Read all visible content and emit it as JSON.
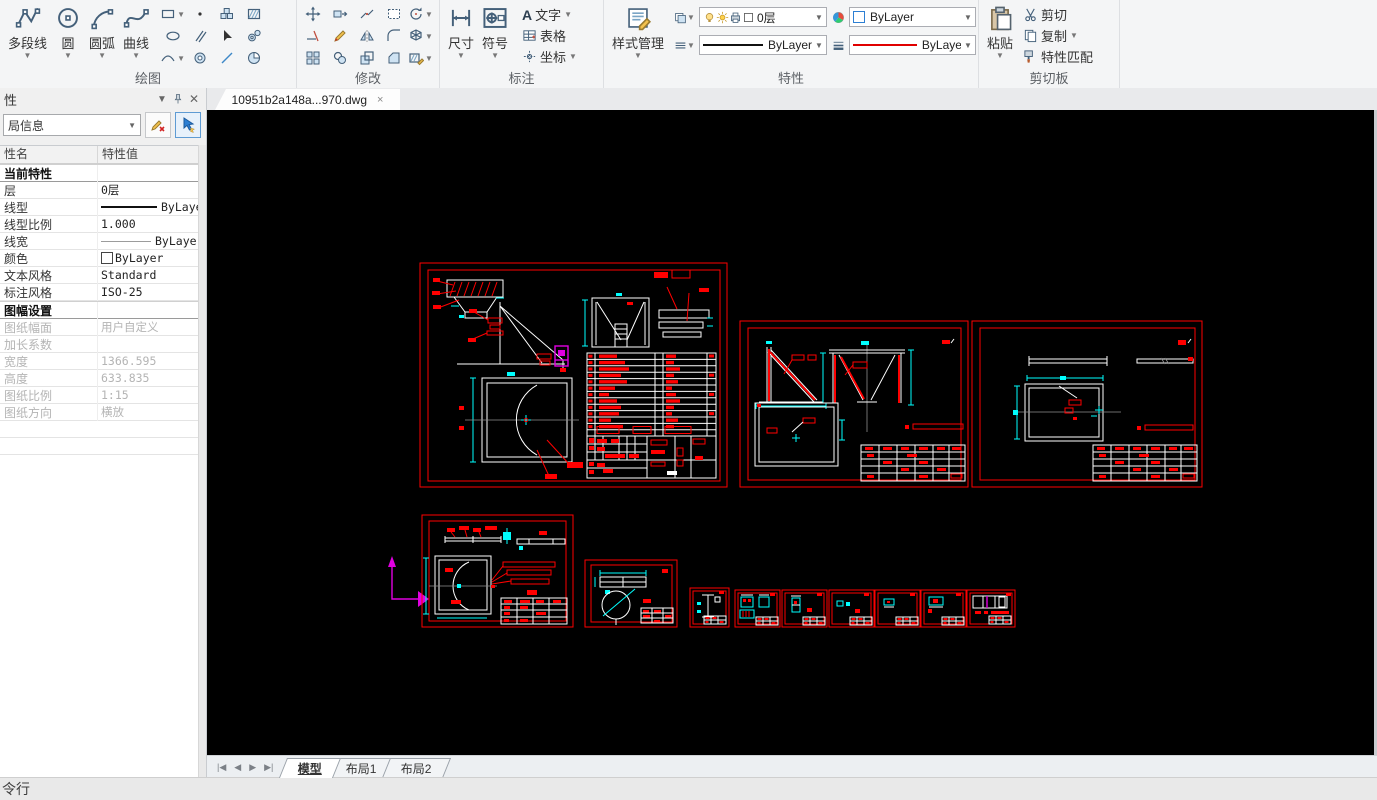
{
  "ribbon": {
    "draw": {
      "label": "绘图",
      "polyline": "多段线",
      "circle": "圆",
      "arc": "圆弧",
      "spline": "曲线",
      "small_icons": [
        "rectangle",
        "ellipse",
        "curve",
        "point",
        "parallel",
        "donut",
        "blocks",
        "pick-arrow",
        "line",
        "hatch",
        "gears",
        "pie"
      ]
    },
    "modify": {
      "label": "修改",
      "small_icons": [
        "move",
        "trim",
        "array",
        "stretch",
        "edit-pencil",
        "copy-object",
        "break",
        "mirror",
        "scale",
        "select-rect",
        "fillet",
        "chamfer",
        "rotate",
        "explode",
        "hatch-edit"
      ]
    },
    "annotate": {
      "label": "标注",
      "dim": "尺寸",
      "symbol": "符号",
      "text": "文字",
      "table": "表格",
      "coord": "坐标"
    },
    "props": {
      "label": "特性",
      "style_manager": "样式管理",
      "layer": "0层",
      "color": "ByLayer",
      "linetype": "ByLayer",
      "lineweight": "ByLayer",
      "layer_icons": [
        "bulb",
        "sun",
        "printer",
        "layer-color"
      ]
    },
    "clipboard": {
      "label": "剪切板",
      "paste": "粘贴",
      "cut": "剪切",
      "copy": "复制",
      "match": "特性匹配"
    }
  },
  "document_tab": {
    "title": "10951b2a148a...970.dwg",
    "close": "×"
  },
  "panel": {
    "title": "性",
    "selector": "局信息",
    "col_name": "性名",
    "col_value": "特性值",
    "rows": [
      {
        "type": "section",
        "name": "当前特性",
        "value": ""
      },
      {
        "type": "row",
        "name": "层",
        "value": "0层"
      },
      {
        "type": "row",
        "name": "线型",
        "value": "ByLayer",
        "swatch": "solid-line",
        "align": "right"
      },
      {
        "type": "row",
        "name": "线型比例",
        "value": "1.000"
      },
      {
        "type": "row",
        "name": "线宽",
        "value": "ByLayer",
        "swatch": "thin-line",
        "align": "right"
      },
      {
        "type": "row",
        "name": "颜色",
        "value": "ByLayer",
        "swatch": "color-box"
      },
      {
        "type": "row",
        "name": "文本风格",
        "value": "Standard"
      },
      {
        "type": "row",
        "name": "标注风格",
        "value": "ISO-25"
      },
      {
        "type": "section",
        "name": "图幅设置",
        "value": ""
      },
      {
        "type": "row",
        "name": "图纸幅面",
        "value": "用户自定义",
        "disabled": true
      },
      {
        "type": "row",
        "name": "加长系数",
        "value": "",
        "disabled": true
      },
      {
        "type": "row",
        "name": "宽度",
        "value": "1366.595",
        "disabled": true
      },
      {
        "type": "row",
        "name": "高度",
        "value": "633.835",
        "disabled": true
      },
      {
        "type": "row",
        "name": "图纸比例",
        "value": "1:15",
        "disabled": true
      },
      {
        "type": "row",
        "name": "图纸方向",
        "value": "横放",
        "disabled": true
      }
    ]
  },
  "layout_tabs": {
    "items": [
      "模型",
      "布局1",
      "布局2"
    ],
    "active": "模型"
  },
  "command_bar": {
    "label": "令行"
  },
  "colors": {
    "sheet_border": "#ff0000",
    "linework": "#ffffff",
    "dimension": "#00ffff",
    "ucs": "#e000e0",
    "canvas_bg": "#000000",
    "accent": "#2d7fd3"
  }
}
